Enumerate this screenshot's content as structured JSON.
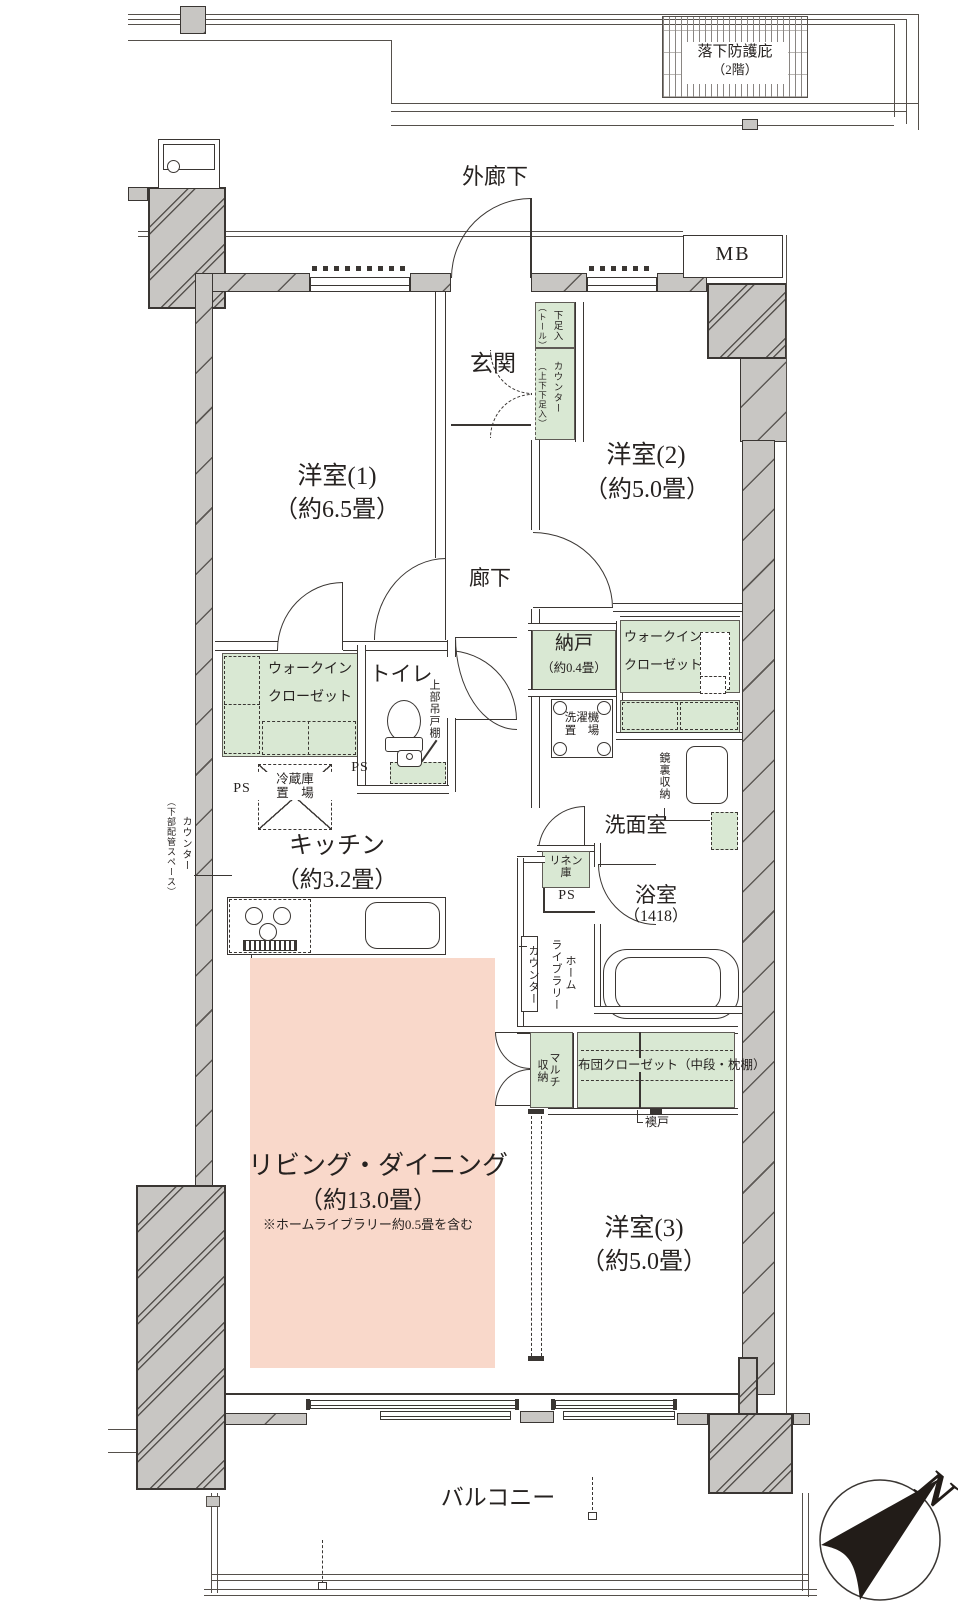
{
  "floorplan": {
    "compass_label": "N",
    "canopy": {
      "line1": "落下防護庇",
      "line2": "（2階）"
    },
    "outer_corridor": "外廊下",
    "meter_box": "MB",
    "balcony": "バルコニー",
    "ps": "PS",
    "rooms": {
      "genkan": "玄関",
      "roka": "廊下",
      "toilet": "トイレ",
      "senmen": "洗面室",
      "yoshitsu1": {
        "name": "洋室(1)",
        "size": "（約6.5畳）"
      },
      "yoshitsu2": {
        "name": "洋室(2)",
        "size": "（約5.0畳）"
      },
      "yoshitsu3": {
        "name": "洋室(3)",
        "size": "（約5.0畳）"
      },
      "living": {
        "name": "リビング・ダイニング",
        "size": "（約13.0畳）",
        "note": "※ホームライブラリー約0.5畳を含む"
      },
      "kitchen": {
        "name": "キッチン",
        "size": "（約3.2畳）"
      },
      "nando": {
        "name": "納戸",
        "size": "（約0.4畳）"
      },
      "bath": {
        "name": "浴室",
        "size": "（1418）"
      }
    },
    "storage": {
      "wic": {
        "line1": "ウォークイン",
        "line2": "クローゼット"
      },
      "shoe_tall": {
        "col1": "下足入",
        "col2": "（トール）"
      },
      "shoe_counter": {
        "col1": "カウンター",
        "col2": "（上下下足入）"
      },
      "linen": {
        "line1": "リネン",
        "line2": "庫"
      },
      "futon": "布団クローゼット（中段・枕棚）",
      "multi": {
        "col1": "マルチ",
        "col2": "収納"
      },
      "kagamiura": "鏡裏収納",
      "jobu_tsuritodana": "上部吊戸棚"
    },
    "equipment": {
      "reizoko": {
        "line1": "冷蔵庫",
        "line2": "置　場"
      },
      "sentakuki": {
        "line1": "洗濯機",
        "line2": "置　場"
      },
      "glass_panel": "ガラスパネル",
      "fusuma": "襖戸",
      "counter_pipe": {
        "col1": "カウンター",
        "col2": "（下部配管スペース）"
      },
      "home_library": {
        "col1": "ホーム",
        "col2": "ライブラリー",
        "col3": "カウンター"
      }
    },
    "colors": {
      "green": "#d9e8d3",
      "pink": "#f9d8ca",
      "wall": "#c8c6c3",
      "line": "#3a3633"
    }
  }
}
